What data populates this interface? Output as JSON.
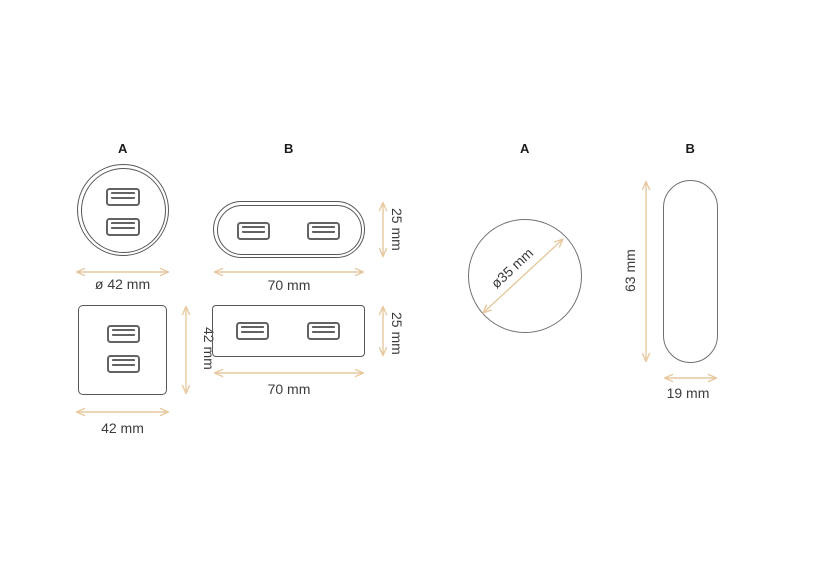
{
  "colors": {
    "outline": "#58585b",
    "outline_light": "#707174",
    "usb_border": "#636366",
    "dim_arrow": "#e7c9a0",
    "dim_text": "#3c3c3e",
    "label_text": "#1c1c1e"
  },
  "left": {
    "label_a": "A",
    "label_b": "B",
    "dims": {
      "circle_diameter": "ø 42 mm",
      "pill_width": "70 mm",
      "pill_height": "25 mm",
      "square_width": "42 mm",
      "square_height": "42 mm",
      "rect_width": "70 mm",
      "rect_height": "25 mm"
    }
  },
  "right": {
    "label_a": "A",
    "label_b": "B",
    "dims": {
      "circle_diameter": "ø35 mm",
      "pill_height": "63 mm",
      "pill_width": "19 mm"
    }
  }
}
